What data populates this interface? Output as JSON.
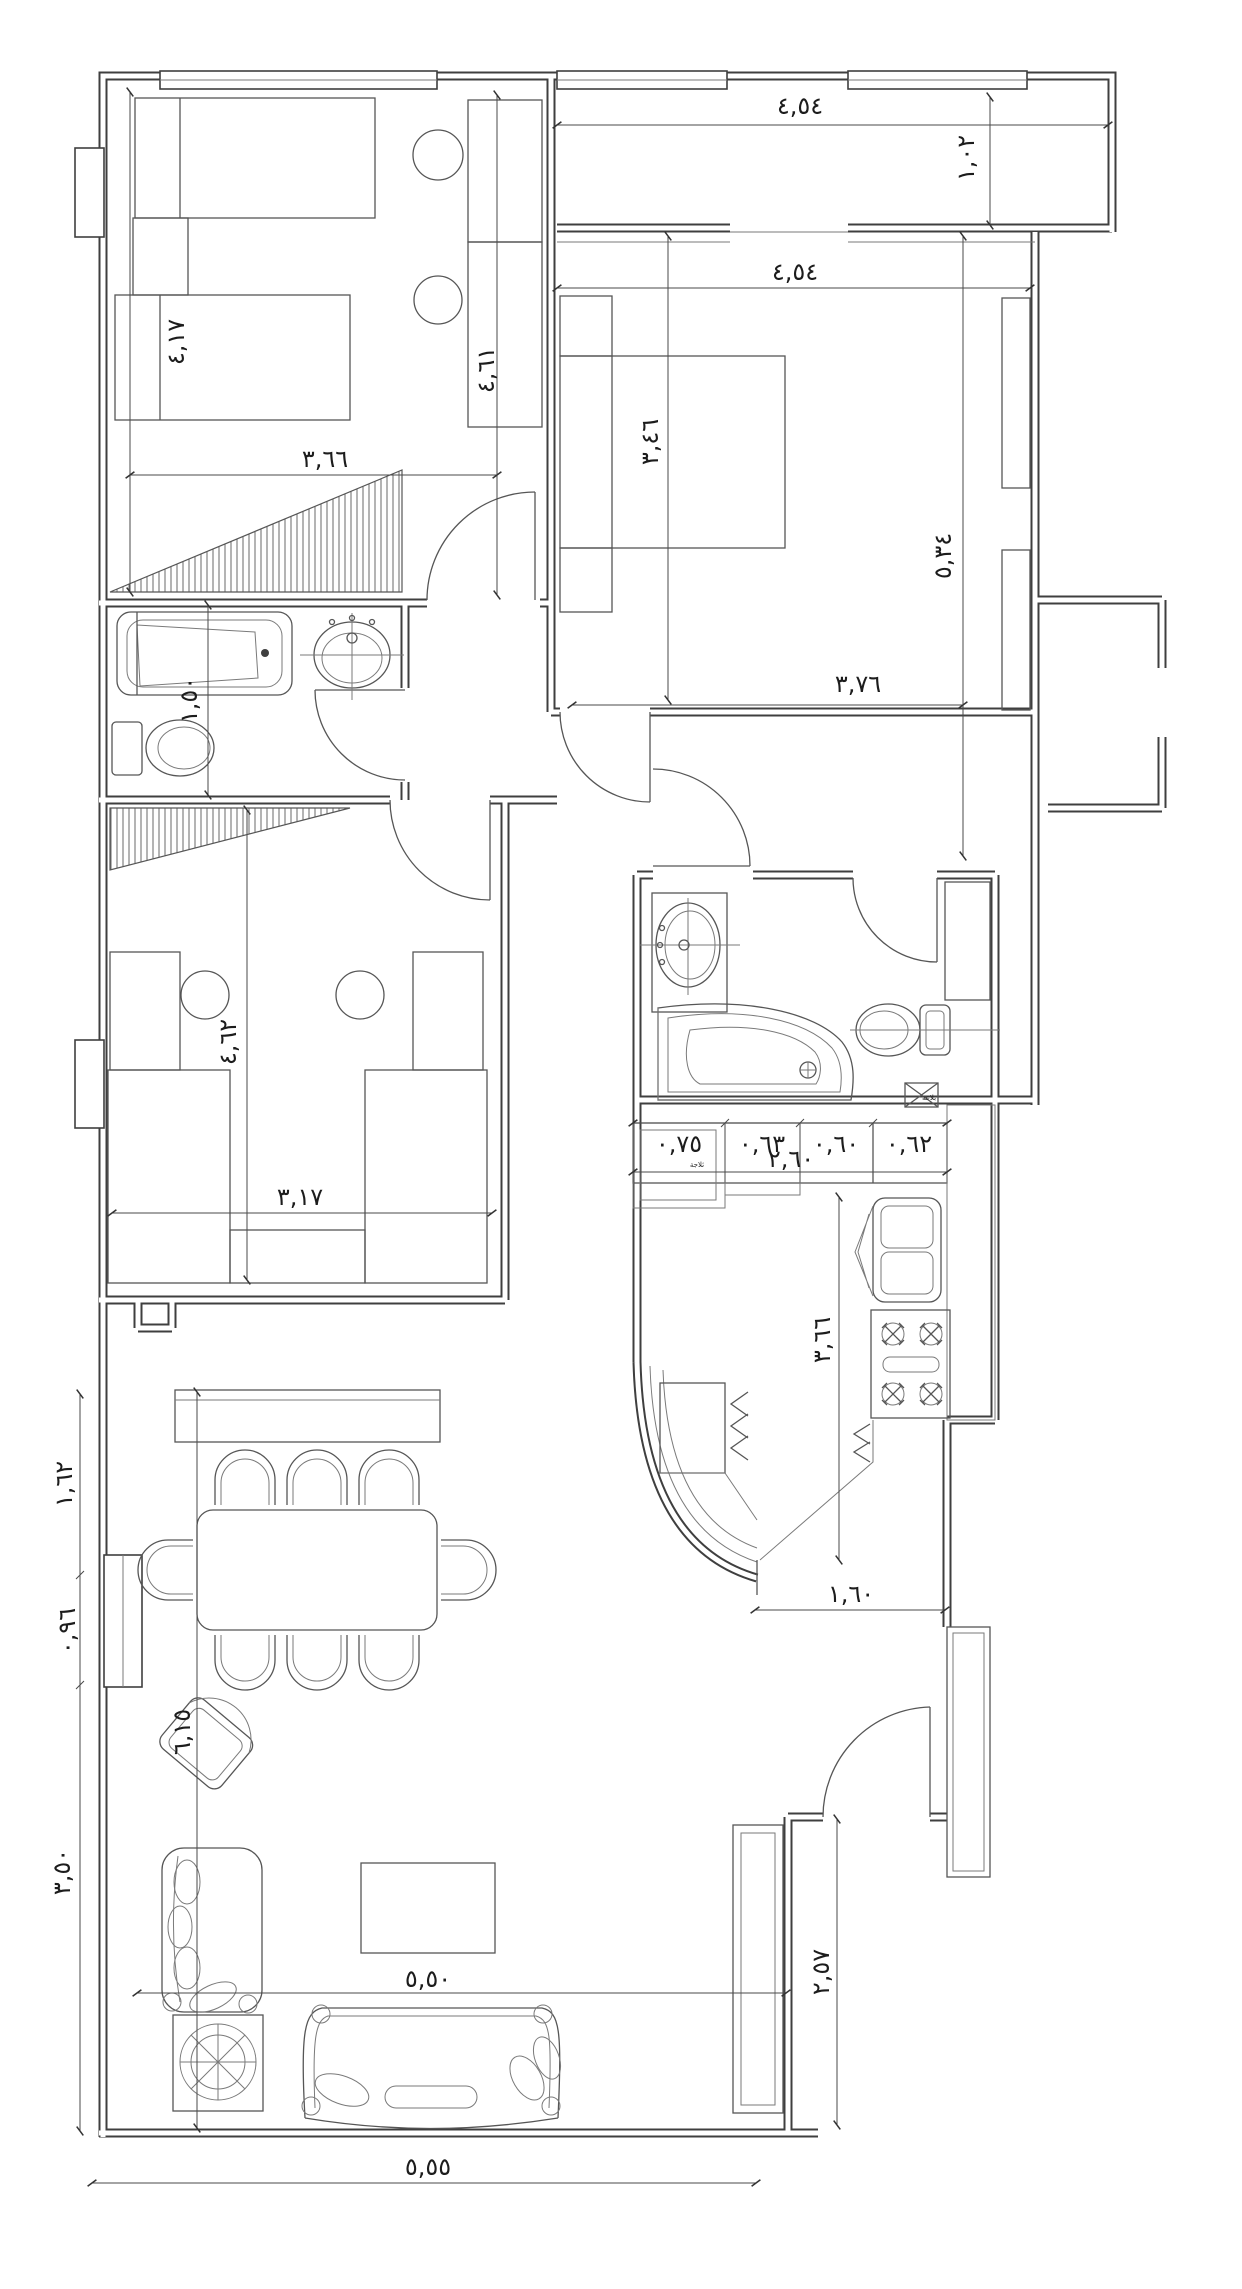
{
  "canvas": {
    "width": 1242,
    "height": 2289,
    "background": "#ffffff",
    "wall_line_color": "#3f3f3f",
    "furniture_line_color": "#565656",
    "dimension_line_color": "#4a4a4a",
    "text_color": "#1c1c1c"
  },
  "dimensions": [
    {
      "id": "balcony-width",
      "text": "٤,٥٤",
      "x": 800,
      "y": 114,
      "rot": 0
    },
    {
      "id": "balcony-depth",
      "text": "١,٠٢",
      "x": 974,
      "y": 158,
      "rot": -90
    },
    {
      "id": "master-width",
      "text": "٤,٥٤",
      "x": 795,
      "y": 280,
      "rot": 0
    },
    {
      "id": "master-bed-length",
      "text": "٣,٤٦",
      "x": 658,
      "y": 442,
      "rot": -90
    },
    {
      "id": "master-depth",
      "text": "٥,٣٤",
      "x": 951,
      "y": 556,
      "rot": -90
    },
    {
      "id": "master-bottom-width",
      "text": "٣,٧٦",
      "x": 858,
      "y": 692,
      "rot": 0
    },
    {
      "id": "bedroom1-left-depth",
      "text": "٤,١٧",
      "x": 184,
      "y": 342,
      "rot": -90
    },
    {
      "id": "bedroom1-right-depth",
      "text": "٤,٦١",
      "x": 494,
      "y": 370,
      "rot": -90
    },
    {
      "id": "bedroom1-width",
      "text": "٣,٦٦",
      "x": 325,
      "y": 467,
      "rot": 0
    },
    {
      "id": "bathroom1-depth",
      "text": "١,٥٠",
      "x": 197,
      "y": 700,
      "rot": -90
    },
    {
      "id": "bedroom2-depth",
      "text": "٤,٦٢",
      "x": 236,
      "y": 1042,
      "rot": -90
    },
    {
      "id": "bedroom2-width",
      "text": "٣,١٧",
      "x": 300,
      "y": 1205,
      "rot": 0
    },
    {
      "id": "kitchen-seg-1",
      "text": "٠,٧٥",
      "x": 679,
      "y": 1152,
      "rot": 0
    },
    {
      "id": "kitchen-seg-2",
      "text": "٠,٦٣",
      "x": 762,
      "y": 1152,
      "rot": 0
    },
    {
      "id": "kitchen-seg-3",
      "text": "٠,٦٠",
      "x": 836,
      "y": 1152,
      "rot": 0
    },
    {
      "id": "kitchen-seg-4",
      "text": "٠,٦٢",
      "x": 909,
      "y": 1152,
      "rot": 0
    },
    {
      "id": "kitchen-total",
      "text": "٢,٦٠",
      "x": 791,
      "y": 1167,
      "rot": 0
    },
    {
      "id": "kitchen-depth",
      "text": "٣,٦٦",
      "x": 830,
      "y": 1340,
      "rot": -90
    },
    {
      "id": "entry-opening",
      "text": "١,٦٠",
      "x": 851,
      "y": 1602,
      "rot": 0
    },
    {
      "id": "terrace-height",
      "text": "٢,٥٧",
      "x": 829,
      "y": 1972,
      "rot": -90
    },
    {
      "id": "living-width",
      "text": "٥,٥٠",
      "x": 428,
      "y": 1987,
      "rot": 0
    },
    {
      "id": "overall-bottom-width",
      "text": "٥,٥٥",
      "x": 428,
      "y": 2175,
      "rot": 0
    },
    {
      "id": "left-seg-1",
      "text": "١,٦٢",
      "x": 72,
      "y": 1484,
      "rot": -90
    },
    {
      "id": "left-seg-2",
      "text": "٠,٩٦",
      "x": 75,
      "y": 1631,
      "rot": -90
    },
    {
      "id": "left-seg-3",
      "text": "٣,٥٠",
      "x": 70,
      "y": 1872,
      "rot": -90
    },
    {
      "id": "living-height",
      "text": "٦,١٥",
      "x": 190,
      "y": 1732,
      "rot": -90
    }
  ],
  "labels": [
    {
      "id": "bath-drain-label",
      "text": "بلاعة",
      "x": 929,
      "y": 1100
    },
    {
      "id": "counter-unit-label",
      "text": "ثلاجة",
      "x": 697,
      "y": 1167
    }
  ]
}
